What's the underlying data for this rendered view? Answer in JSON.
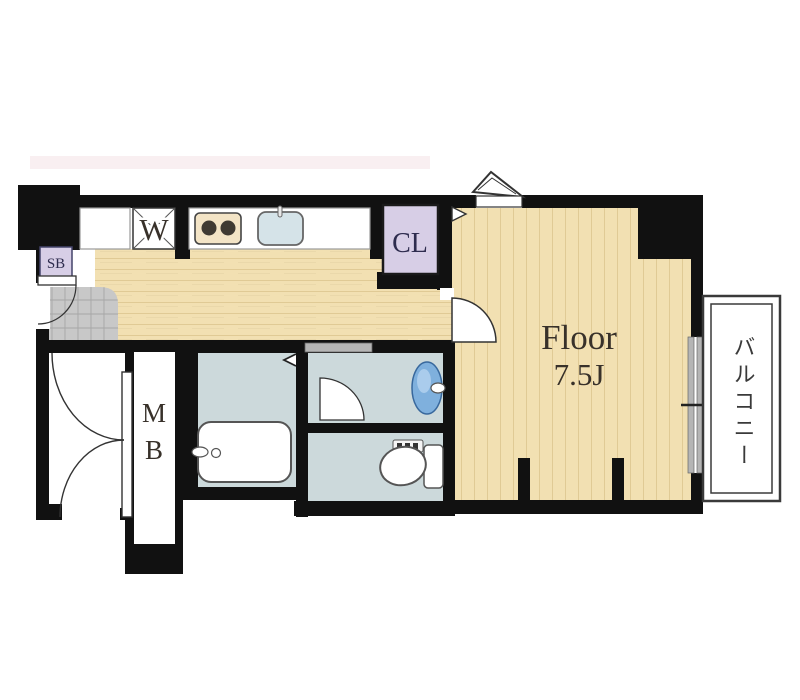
{
  "plan": {
    "type": "apartment-floor-plan",
    "labels": {
      "washer": "W",
      "closet": "CL",
      "shoe_box": "SB",
      "meter_box_m": "M",
      "meter_box_b": "B",
      "main_room_name": "Floor",
      "main_room_size": "7.5J",
      "balcony": "バルコニー"
    },
    "colors": {
      "wall": "#111111",
      "wood": "#f2e0b2",
      "wood_grain": "#e0ca95",
      "closet_fill": "#d7cee6",
      "wet_floor": "#ccd9db",
      "tile": "#c8c8c8",
      "tile_line": "#a6a6a6",
      "sink_blue": "#7fb0dd",
      "sink_highlight": "#aaccec",
      "stove_fill": "#f3e4c6",
      "kitchen_sink_fill": "#d5e3e8",
      "fixture_outline": "#555555",
      "label_color": "#2e2c4e",
      "room_text": "#38312a",
      "balcony_line": "#3a3a3a",
      "slider_gray": "#b5b5b5",
      "watermark_pink": "#f2dce0"
    }
  }
}
